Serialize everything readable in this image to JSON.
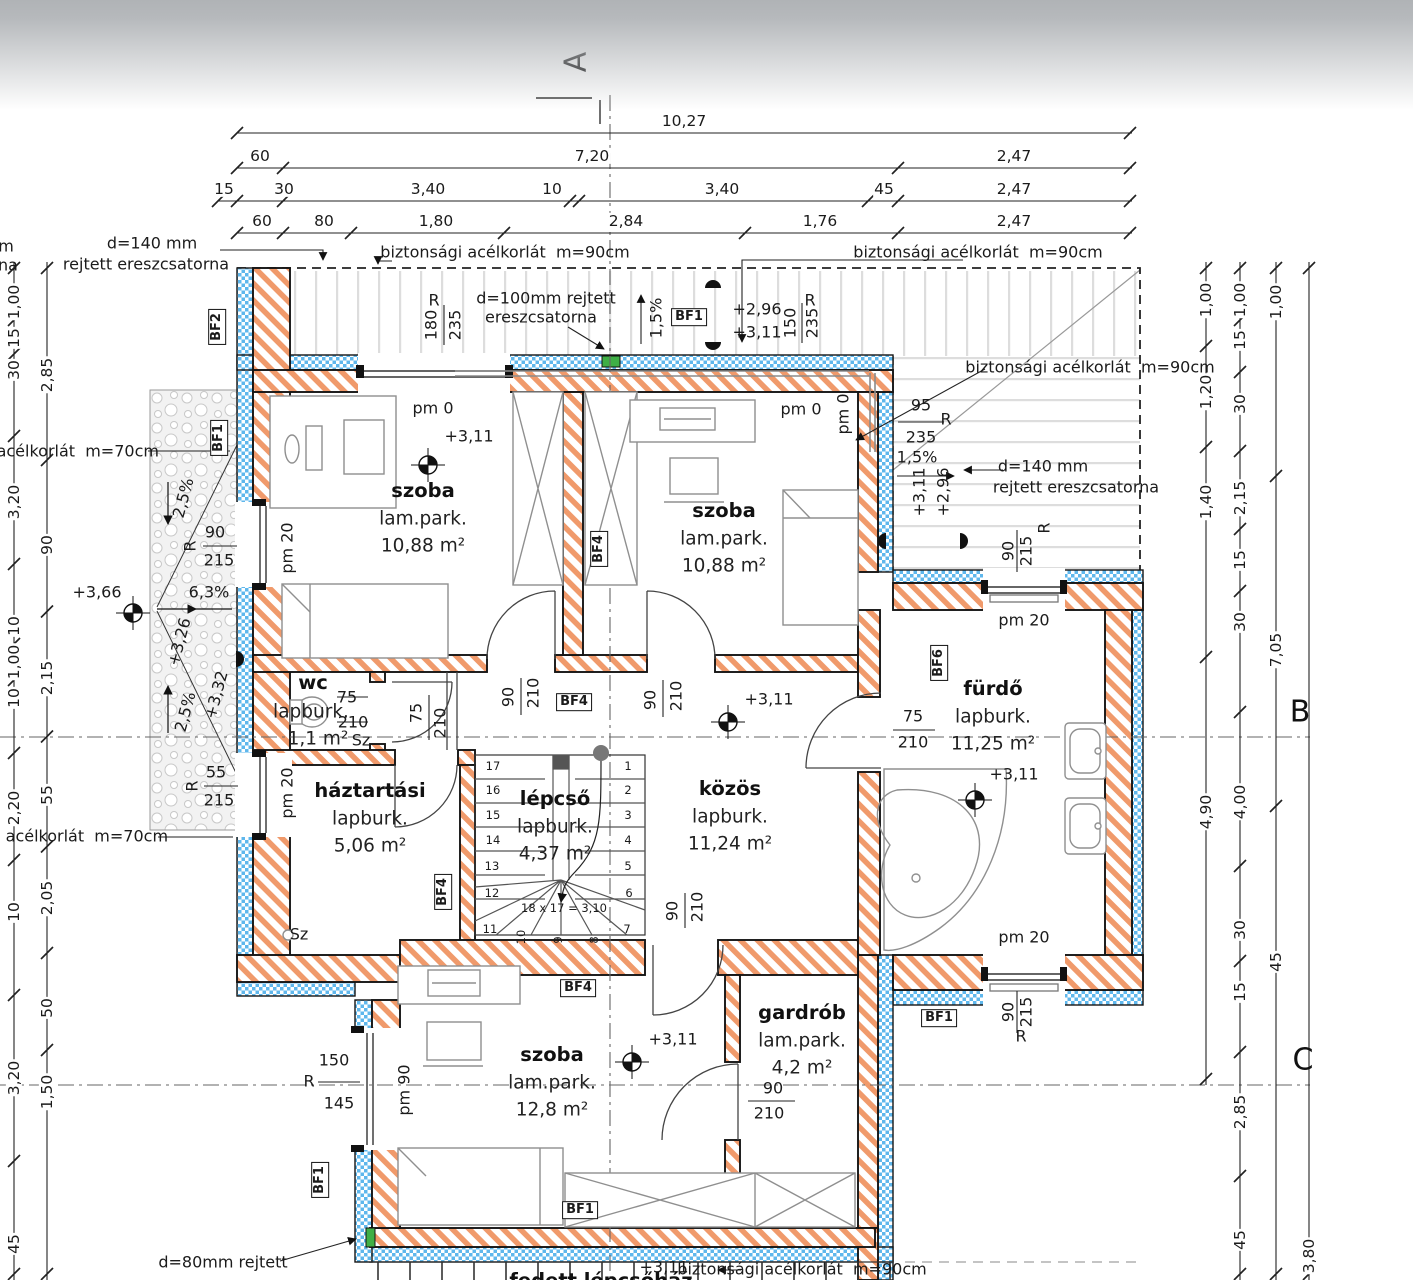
{
  "drawing": {
    "type": "architectural floor plan (emeleti alaprajz)",
    "colors": {
      "wall_hatch": "#f09a6b",
      "insulation_blue": "#5fb7ec",
      "gutter_green": "#3faf46",
      "line": "#1a1a1a",
      "deck_stripe": "#dddddd"
    },
    "section_markers": [
      {
        "t": "A",
        "x": 576,
        "y": 62,
        "r": -90
      },
      {
        "t": "B",
        "x": 1300,
        "y": 712,
        "r": 0
      },
      {
        "t": "C",
        "x": 1303,
        "y": 1060,
        "r": 0
      }
    ],
    "rooms": [
      {
        "name": "szoba",
        "finish": "lam.park.",
        "area": "10,88 m²",
        "x": 423,
        "y": 491
      },
      {
        "name": "szoba",
        "finish": "lam.park.",
        "area": "10,88 m²",
        "x": 724,
        "y": 511
      },
      {
        "name": "fürdő",
        "finish": "lapburk.",
        "area": "11,25 m²",
        "x": 993,
        "y": 689
      },
      {
        "name": "háztartási",
        "finish": "lapburk.",
        "area": "5,06 m²",
        "x": 370,
        "y": 791
      },
      {
        "name": "lépcső",
        "finish": "lapburk.",
        "area": "4,37 m²",
        "x": 555,
        "y": 799
      },
      {
        "name": "közös",
        "finish": "lapburk.",
        "area": "11,24 m²",
        "x": 730,
        "y": 789
      },
      {
        "name": "szoba",
        "finish": "lam.park.",
        "area": "12,8 m²",
        "x": 552,
        "y": 1055
      },
      {
        "name": "gardrób",
        "finish": "lam.park.",
        "area": "4,2 m²",
        "x": 802,
        "y": 1013
      }
    ],
    "stairs": {
      "formula": "18 x 17 = 3,10",
      "numbers": [
        {
          "t": "1",
          "x": 628,
          "y": 766
        },
        {
          "t": "2",
          "x": 628,
          "y": 790
        },
        {
          "t": "3",
          "x": 628,
          "y": 815
        },
        {
          "t": "4",
          "x": 628,
          "y": 840
        },
        {
          "t": "5",
          "x": 628,
          "y": 866
        },
        {
          "t": "6",
          "x": 629,
          "y": 893
        },
        {
          "t": "7",
          "x": 627,
          "y": 929
        },
        {
          "t": "17",
          "x": 493,
          "y": 766
        },
        {
          "t": "16",
          "x": 493,
          "y": 790
        },
        {
          "t": "15",
          "x": 493,
          "y": 815
        },
        {
          "t": "14",
          "x": 493,
          "y": 840
        },
        {
          "t": "13",
          "x": 492,
          "y": 866
        },
        {
          "t": "12",
          "x": 492,
          "y": 893
        },
        {
          "t": "11",
          "x": 490,
          "y": 929
        },
        {
          "t": "10",
          "x": 521,
          "y": 937,
          "r": -90
        },
        {
          "t": "9",
          "x": 558,
          "y": 940,
          "r": -90
        },
        {
          "t": "8",
          "x": 594,
          "y": 940,
          "r": -90
        }
      ]
    },
    "bf_tags": [
      {
        "t": "BF2",
        "x": 217,
        "y": 327,
        "r": -90
      },
      {
        "t": "BF1",
        "x": 219,
        "y": 438,
        "r": -90
      },
      {
        "t": "BF1",
        "x": 689,
        "y": 317
      },
      {
        "t": "BF4",
        "x": 599,
        "y": 549,
        "r": -90
      },
      {
        "t": "BF4",
        "x": 574,
        "y": 702
      },
      {
        "t": "BF6",
        "x": 939,
        "y": 663,
        "r": -90
      },
      {
        "t": "BF4",
        "x": 443,
        "y": 892,
        "r": -90
      },
      {
        "t": "BF4",
        "x": 578,
        "y": 988
      },
      {
        "t": "BF1",
        "x": 580,
        "y": 1210
      },
      {
        "t": "BF1",
        "x": 320,
        "y": 1180,
        "r": -90
      },
      {
        "t": "BF1",
        "x": 939,
        "y": 1018
      }
    ],
    "texts": [
      {
        "t": "d=140 mm",
        "x": 152,
        "y": 244
      },
      {
        "t": "rejtett ereszcsatorna",
        "x": 146,
        "y": 265
      },
      {
        "t": "m",
        "x": 6,
        "y": 247
      },
      {
        "t": "na",
        "x": 8,
        "y": 266
      },
      {
        "t": "biztonsági acélkorlát  m=90cm",
        "x": 505,
        "y": 253
      },
      {
        "t": "biztonsági acélkorlát  m=90cm",
        "x": 978,
        "y": 253
      },
      {
        "t": "d=100mm rejtett",
        "x": 546,
        "y": 299
      },
      {
        "t": "ereszcsatorna",
        "x": 541,
        "y": 318
      },
      {
        "t": "1,5%",
        "x": 657,
        "y": 318,
        "r": -90
      },
      {
        "t": "+2,96",
        "x": 757,
        "y": 310
      },
      {
        "t": "+3,11",
        "x": 757,
        "y": 333
      },
      {
        "t": "R",
        "x": 810,
        "y": 301
      },
      {
        "t": "150",
        "x": 791,
        "y": 323,
        "r": -90
      },
      {
        "t": "235",
        "x": 813,
        "y": 323,
        "r": -90
      },
      {
        "t": "R",
        "x": 434,
        "y": 301
      },
      {
        "t": "180",
        "x": 432,
        "y": 325,
        "r": -90
      },
      {
        "t": "235",
        "x": 456,
        "y": 325,
        "r": -90
      },
      {
        "t": "biztonsági acélkorlát  m=90cm",
        "x": 1090,
        "y": 368
      },
      {
        "t": "95",
        "x": 921,
        "y": 406
      },
      {
        "t": "235",
        "x": 921,
        "y": 438
      },
      {
        "t": "R",
        "x": 946,
        "y": 420
      },
      {
        "t": "1,5%",
        "x": 917,
        "y": 458
      },
      {
        "t": "+3,11",
        "x": 920,
        "y": 492,
        "r": -90
      },
      {
        "t": "+2,96",
        "x": 944,
        "y": 492,
        "r": -90
      },
      {
        "t": "d=140 mm",
        "x": 1043,
        "y": 467
      },
      {
        "t": "rejtett ereszcsatorna",
        "x": 1076,
        "y": 488
      },
      {
        "t": "90",
        "x": 1009,
        "y": 551,
        "r": -90
      },
      {
        "t": "215",
        "x": 1027,
        "y": 551,
        "r": -90
      },
      {
        "t": "R",
        "x": 1045,
        "y": 528,
        "r": -90
      },
      {
        "t": "pm 20",
        "x": 1024,
        "y": 621
      },
      {
        "t": "pm 0",
        "x": 433,
        "y": 409
      },
      {
        "t": "+3,11",
        "x": 469,
        "y": 437
      },
      {
        "t": "pm 0",
        "x": 801,
        "y": 410
      },
      {
        "t": "pm 0",
        "x": 844,
        "y": 414,
        "r": -90
      },
      {
        "t": "i acélkorlát  m=70cm",
        "x": 73,
        "y": 452
      },
      {
        "t": "pm 20",
        "x": 288,
        "y": 548,
        "r": -90
      },
      {
        "t": "90",
        "x": 215,
        "y": 533
      },
      {
        "t": "215",
        "x": 219,
        "y": 561
      },
      {
        "t": "R",
        "x": 191,
        "y": 546,
        "r": -90
      },
      {
        "t": "+3,66",
        "x": 97,
        "y": 593
      },
      {
        "t": "6,3%",
        "x": 209,
        "y": 593
      },
      {
        "t": "2,5%",
        "x": 184,
        "y": 498,
        "r": -75
      },
      {
        "t": "+3,26",
        "x": 180,
        "y": 642,
        "r": -75
      },
      {
        "t": "+3,32",
        "x": 217,
        "y": 695,
        "r": -75
      },
      {
        "t": "2,5%",
        "x": 186,
        "y": 712,
        "r": -75
      },
      {
        "t": "gi acélkorlát  m=70cm",
        "x": 77,
        "y": 837
      },
      {
        "t": "pm 20",
        "x": 288,
        "y": 793,
        "r": -90
      },
      {
        "t": "55",
        "x": 216,
        "y": 773
      },
      {
        "t": "215",
        "x": 219,
        "y": 801
      },
      {
        "t": "R",
        "x": 193,
        "y": 786,
        "r": -90
      },
      {
        "t": "wc",
        "x": 313,
        "y": 683,
        "c": "rm"
      },
      {
        "t": "75",
        "x": 347,
        "y": 698
      },
      {
        "t": "lapburk.",
        "x": 311,
        "y": 712,
        "c": "rs"
      },
      {
        "t": "210",
        "x": 353,
        "y": 723
      },
      {
        "t": "1,1 m²",
        "x": 318,
        "y": 739,
        "c": "rs"
      },
      {
        "t": "Sz",
        "x": 361,
        "y": 741
      },
      {
        "t": "75",
        "x": 417,
        "y": 713,
        "r": -90
      },
      {
        "t": "210",
        "x": 441,
        "y": 723,
        "r": -90
      },
      {
        "t": "90",
        "x": 509,
        "y": 697,
        "r": -90
      },
      {
        "t": "210",
        "x": 534,
        "y": 693,
        "r": -90
      },
      {
        "t": "90",
        "x": 651,
        "y": 700,
        "r": -90
      },
      {
        "t": "210",
        "x": 677,
        "y": 696,
        "r": -90
      },
      {
        "t": "+3,11",
        "x": 769,
        "y": 700
      },
      {
        "t": "75",
        "x": 913,
        "y": 717
      },
      {
        "t": "210",
        "x": 913,
        "y": 743
      },
      {
        "t": "+3,11",
        "x": 1014,
        "y": 775
      },
      {
        "t": "Sz",
        "x": 299,
        "y": 935
      },
      {
        "t": "90",
        "x": 673,
        "y": 911,
        "r": -90
      },
      {
        "t": "210",
        "x": 698,
        "y": 907,
        "r": -90
      },
      {
        "t": "pm 20",
        "x": 1024,
        "y": 938
      },
      {
        "t": "90",
        "x": 1009,
        "y": 1012,
        "r": -90
      },
      {
        "t": "215",
        "x": 1027,
        "y": 1012,
        "r": -90
      },
      {
        "t": "R",
        "x": 1021,
        "y": 1037
      },
      {
        "t": "+3,11",
        "x": 673,
        "y": 1040
      },
      {
        "t": "150",
        "x": 334,
        "y": 1061
      },
      {
        "t": "145",
        "x": 339,
        "y": 1104
      },
      {
        "t": "R",
        "x": 309,
        "y": 1082
      },
      {
        "t": "pm 90",
        "x": 405,
        "y": 1090,
        "r": -90
      },
      {
        "t": "90",
        "x": 773,
        "y": 1089
      },
      {
        "t": "210",
        "x": 769,
        "y": 1114
      },
      {
        "t": "d=80mm rejtett",
        "x": 223,
        "y": 1263
      },
      {
        "t": "+3,11",
        "x": 664,
        "y": 1268
      },
      {
        "t": "biztonsági acélkorlát  m=90cm",
        "x": 802,
        "y": 1270
      },
      {
        "t": "fedett lépcsőház",
        "x": 601,
        "y": 1281,
        "c": "rm"
      }
    ],
    "dim_chains": [
      {
        "dir": "h",
        "pos": 133,
        "from": 237,
        "to": 1132,
        "ticks": [
          237,
          1130
        ],
        "labels": [
          {
            "t": "10,27",
            "p": 684
          }
        ]
      },
      {
        "dir": "h",
        "pos": 168,
        "from": 237,
        "to": 1132,
        "ticks": [
          237,
          283,
          898,
          1130
        ],
        "labels": [
          {
            "t": "60",
            "p": 260
          },
          {
            "t": "7,20",
            "p": 592
          },
          {
            "t": "2,47",
            "p": 1014
          }
        ]
      },
      {
        "dir": "h",
        "pos": 201,
        "from": 218,
        "to": 1132,
        "ticks": [
          218,
          237,
          283,
          570,
          579,
          868,
          898,
          1130
        ],
        "labels": [
          {
            "t": "15",
            "p": 224
          },
          {
            "t": "30",
            "p": 284
          },
          {
            "t": "3,40",
            "p": 428
          },
          {
            "t": "10",
            "p": 552
          },
          {
            "t": "3,40",
            "p": 722
          },
          {
            "t": "45",
            "p": 884
          },
          {
            "t": "2,47",
            "p": 1014
          }
        ]
      },
      {
        "dir": "h",
        "pos": 233,
        "from": 237,
        "to": 1132,
        "ticks": [
          237,
          283,
          351,
          504,
          745,
          898,
          1130
        ],
        "labels": [
          {
            "t": "60",
            "p": 262
          },
          {
            "t": "80",
            "p": 324
          },
          {
            "t": "1,80",
            "p": 436
          },
          {
            "t": "2,84",
            "p": 626
          },
          {
            "t": "1,76",
            "p": 820
          },
          {
            "t": "2,47",
            "p": 1014
          }
        ]
      },
      {
        "dir": "v",
        "pos": 14,
        "from": 262,
        "to": 1280,
        "labels": [
          {
            "t": "1,00",
            "p": 302
          },
          {
            "t": "15",
            "p": 338
          },
          {
            "t": "30",
            "p": 370
          },
          {
            "t": "3,20",
            "p": 502
          },
          {
            "t": "10",
            "p": 626
          },
          {
            "t": "1,00",
            "p": 662
          },
          {
            "t": "10",
            "p": 698
          },
          {
            "t": "2,20",
            "p": 808
          },
          {
            "t": "10",
            "p": 912
          },
          {
            "t": "3,20",
            "p": 1078
          },
          {
            "t": "45",
            "p": 1244
          }
        ]
      },
      {
        "dir": "v",
        "pos": 47,
        "from": 262,
        "to": 1280,
        "labels": [
          {
            "t": "2,85",
            "p": 375
          },
          {
            "t": "90",
            "p": 545
          },
          {
            "t": "2,15",
            "p": 678
          },
          {
            "t": "55",
            "p": 795
          },
          {
            "t": "2,05",
            "p": 898
          },
          {
            "t": "50",
            "p": 1008
          },
          {
            "t": "1,50",
            "p": 1092
          }
        ]
      },
      {
        "dir": "v",
        "pos": 1206,
        "from": 262,
        "to": 1085,
        "labels": [
          {
            "t": "1,00",
            "p": 300
          },
          {
            "t": "1,20",
            "p": 392
          },
          {
            "t": "1,40",
            "p": 502
          },
          {
            "t": "4,90",
            "p": 812
          }
        ]
      },
      {
        "dir": "v",
        "pos": 1240,
        "from": 262,
        "to": 1280,
        "labels": [
          {
            "t": "1,00",
            "p": 300
          },
          {
            "t": "15",
            "p": 340
          },
          {
            "t": "30",
            "p": 404
          },
          {
            "t": "2,15",
            "p": 498
          },
          {
            "t": "15",
            "p": 560
          },
          {
            "t": "30",
            "p": 622
          },
          {
            "t": "4,00",
            "p": 802
          },
          {
            "t": "30",
            "p": 930
          },
          {
            "t": "15",
            "p": 992
          },
          {
            "t": "2,85",
            "p": 1112
          },
          {
            "t": "45",
            "p": 1240
          }
        ]
      },
      {
        "dir": "v",
        "pos": 1276,
        "from": 262,
        "to": 1280,
        "labels": [
          {
            "t": "1,00",
            "p": 302
          },
          {
            "t": "7,05",
            "p": 650
          },
          {
            "t": "45",
            "p": 962
          }
        ]
      },
      {
        "dir": "v",
        "pos": 1309,
        "from": 262,
        "to": 1280,
        "labels": [
          {
            "t": "3,80",
            "p": 1256
          }
        ]
      }
    ]
  }
}
